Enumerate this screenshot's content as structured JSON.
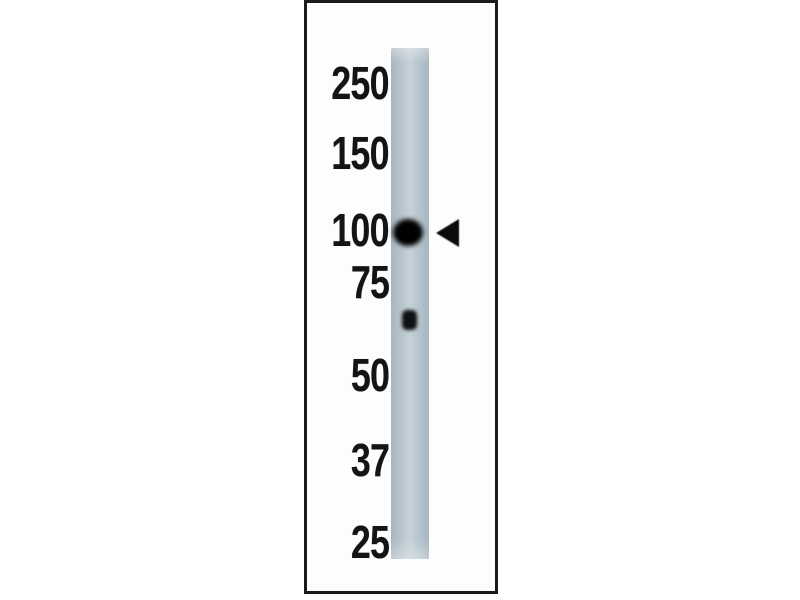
{
  "figure": {
    "kind": "western-blot",
    "ladder_unit": "kDa",
    "markers": [
      {
        "label": "250"
      },
      {
        "label": "150"
      },
      {
        "label": "100"
      },
      {
        "label": "75"
      },
      {
        "label": "50"
      },
      {
        "label": "37"
      },
      {
        "label": "25"
      }
    ],
    "bands": [
      {
        "name": "main-band",
        "approx_kda": 100,
        "intensity": "strong",
        "marked_by_arrow": true
      },
      {
        "name": "minor-band",
        "approx_kda": 65,
        "intensity": "weak",
        "marked_by_arrow": false
      }
    ],
    "pointer": {
      "shape": "left-pointing-triangle",
      "points_to": "main-band"
    },
    "colors": {
      "page_background": "#ffffff",
      "panel_border": "#1b1b1b",
      "panel_background": "#fdfdfd",
      "lane_edge": "#a7b5bf",
      "lane_fill": "#b8c5ce",
      "lane_highlight": "#c7d1d8",
      "band_color": "#000000",
      "label_color": "#141414",
      "pointer_color": "#0b0b0b"
    }
  }
}
